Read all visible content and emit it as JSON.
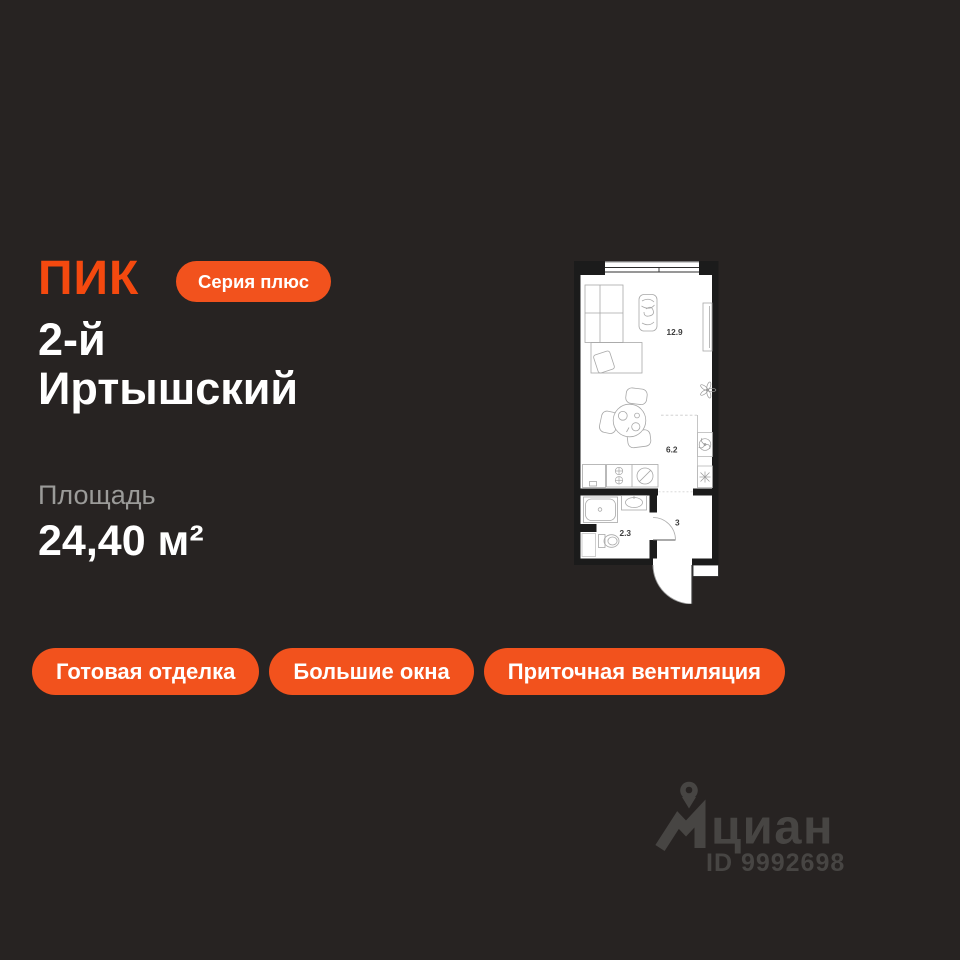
{
  "brand": {
    "logo_text": "ПИК",
    "series_label": "Серия плюс"
  },
  "listing": {
    "title_line1": "2-й",
    "title_line2": "Иртышский",
    "area_label": "Площадь",
    "area_value": "24,40 м²"
  },
  "floorplan": {
    "rooms": [
      {
        "id": "living-room",
        "area": "12.9"
      },
      {
        "id": "kitchen",
        "area": "6.2"
      },
      {
        "id": "bathroom",
        "area": "2.3"
      },
      {
        "id": "hallway",
        "area": "3"
      }
    ],
    "icons": [
      "window",
      "wardrobe",
      "desk-chair",
      "armchair",
      "plant",
      "dining-table",
      "stove-burners",
      "washing-machine",
      "ventilation-fan",
      "snowflake-vent",
      "shower",
      "sink",
      "toilet",
      "door-arc"
    ]
  },
  "features": [
    "Готовая отделка",
    "Большие окна",
    "Приточная вентиляция"
  ],
  "watermark": {
    "logo_text": "циан",
    "id_label": "ID 9992698"
  },
  "colors": {
    "background": "#272322",
    "accent": "#F2521D",
    "logo_orange": "#F4490F",
    "plan_walls": "#1B1B1B",
    "watermark_gray": "#4A4846",
    "muted_text": "#9B9B99"
  }
}
